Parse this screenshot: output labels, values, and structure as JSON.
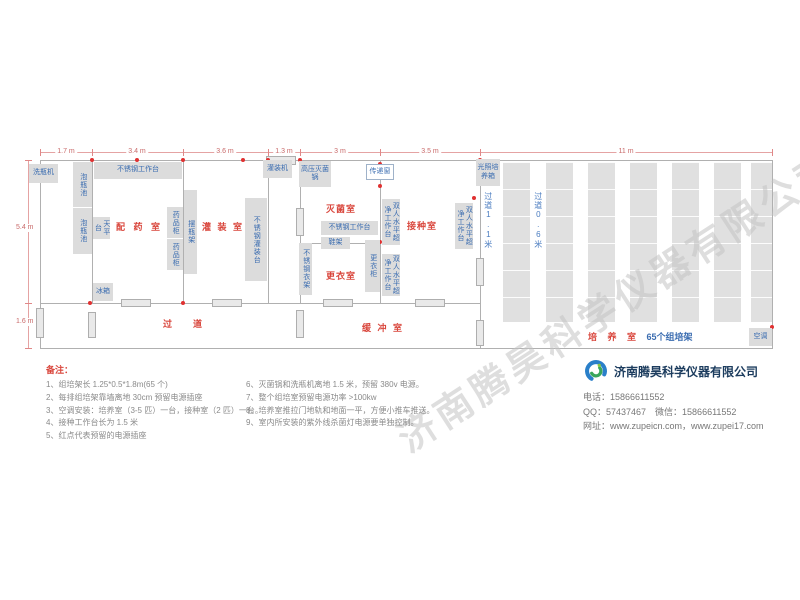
{
  "watermark": "济南腾昊科学仪器有限公司",
  "company": {
    "name": "济南腾昊科学仪器有限公司",
    "phone_line": "电话：15866611552",
    "qq_line": "QQ：57437467　微信：15866611552",
    "web_line": "网址：www.zupeicn.com，www.zupei17.com"
  },
  "notes": {
    "title": "备注：",
    "col1": [
      "1、组培架长 1.25*0.5*1.8m(65 个)",
      "2、每排组培架靠墙离地 30cm 预留电源插座",
      "3、空调安装：培养室（3-5 匹）一台，接种室（2 匹）一台。",
      "4、接种工作台长为 1.5 米",
      "5、红点代表预留的电源插座"
    ],
    "col2": [
      "6、灭菌锅和洗瓶机离地 1.5 米，预留 380v 电源。",
      "7、整个组培室预留电源功率 >100kw",
      "8、培养室推拉门地轨和地面一平，方便小推车推送。",
      "9、室内所安装的紫外线杀菌灯电源要单独控制。"
    ]
  },
  "colors": {
    "room_label_red": "#d9463c",
    "equipment_blue": "#3a6cb0",
    "dimension_pink": "#c96a6a",
    "outlet_red": "#e03131",
    "wall_gray": "#b0b0b0"
  },
  "plan": {
    "walls": [
      [
        40,
        160,
        733,
        1
      ],
      [
        40,
        348,
        733,
        1
      ],
      [
        40,
        160,
        1,
        189
      ],
      [
        772,
        160,
        1,
        189
      ],
      [
        92,
        160,
        1,
        144
      ],
      [
        183,
        160,
        1,
        144
      ],
      [
        268,
        160,
        1,
        144
      ],
      [
        300,
        160,
        1,
        144
      ],
      [
        380,
        160,
        1,
        144
      ],
      [
        480,
        160,
        1,
        189
      ],
      [
        300,
        243,
        81,
        1
      ],
      [
        40,
        303,
        441,
        1
      ]
    ],
    "doors": [
      [
        121,
        299,
        30,
        8
      ],
      [
        212,
        299,
        30,
        8
      ],
      [
        323,
        299,
        30,
        8
      ],
      [
        415,
        299,
        30,
        8
      ],
      [
        266,
        156,
        30,
        9
      ],
      [
        296,
        208,
        8,
        28
      ],
      [
        296,
        310,
        8,
        28
      ],
      [
        476,
        258,
        8,
        28
      ],
      [
        476,
        320,
        8,
        26
      ],
      [
        36,
        308,
        8,
        30
      ],
      [
        88,
        312,
        8,
        26
      ]
    ],
    "racks": [
      [
        503,
        162,
        27,
        160
      ],
      [
        546,
        162,
        27,
        160
      ],
      [
        588,
        162,
        27,
        160
      ],
      [
        630,
        162,
        27,
        160
      ],
      [
        672,
        162,
        27,
        160
      ],
      [
        714,
        162,
        27,
        160
      ],
      [
        751,
        162,
        21,
        160
      ]
    ],
    "outlets": [
      [
        92,
        160
      ],
      [
        137,
        160
      ],
      [
        183,
        160
      ],
      [
        243,
        160
      ],
      [
        268,
        160
      ],
      [
        300,
        160
      ],
      [
        480,
        160
      ],
      [
        380,
        164
      ],
      [
        380,
        186
      ],
      [
        474,
        198
      ],
      [
        380,
        242
      ],
      [
        183,
        303
      ],
      [
        90,
        303
      ],
      [
        772,
        327
      ]
    ],
    "equipment": [
      {
        "name": "bottle-washer-box",
        "label": "洗瓶机",
        "x": 29,
        "y": 164,
        "w": 29,
        "h": 19
      },
      {
        "name": "bottle-soak-pool-1",
        "label": "泡瓶池",
        "x": 73,
        "y": 162,
        "w": 19,
        "h": 45,
        "v": true
      },
      {
        "name": "bottle-soak-pool-2",
        "label": "泡瓶池",
        "x": 73,
        "y": 208,
        "w": 19,
        "h": 46,
        "v": true
      },
      {
        "name": "ss-worktable-left",
        "label": "不锈钢工作台",
        "x": 94,
        "y": 162,
        "w": 88,
        "h": 17
      },
      {
        "name": "balance-table",
        "label": "天平台",
        "x": 93,
        "y": 217,
        "w": 17,
        "h": 22,
        "v": true
      },
      {
        "name": "medicine-cabinet-1",
        "label": "药品柜",
        "x": 167,
        "y": 207,
        "w": 16,
        "h": 31,
        "v": true
      },
      {
        "name": "medicine-cabinet-2",
        "label": "药品柜",
        "x": 167,
        "y": 239,
        "w": 16,
        "h": 31,
        "v": true
      },
      {
        "name": "fridge-box",
        "label": "冰箱",
        "x": 93,
        "y": 283,
        "w": 20,
        "h": 18
      },
      {
        "name": "bottle-rack-column",
        "label": "摆瓶架",
        "x": 184,
        "y": 190,
        "w": 13,
        "h": 84,
        "v": true
      },
      {
        "name": "filling-machine-box",
        "label": "灌装机",
        "x": 263,
        "y": 160,
        "w": 29,
        "h": 18
      },
      {
        "name": "ss-filling-table",
        "label": "不锈钢灌装台",
        "x": 245,
        "y": 198,
        "w": 22,
        "h": 83,
        "v": true
      },
      {
        "name": "autoclave-box",
        "label": "高压灭菌锅",
        "x": 299,
        "y": 161,
        "w": 32,
        "h": 26
      },
      {
        "name": "pass-window-box",
        "label": "传递窗",
        "x": 366,
        "y": 164,
        "w": 28,
        "h": 16,
        "o": true
      },
      {
        "name": "ss-worktable-mid",
        "label": "不锈钢工作台",
        "x": 321,
        "y": 221,
        "w": 57,
        "h": 14
      },
      {
        "name": "shoe-rack-box",
        "label": "鞋架",
        "x": 321,
        "y": 237,
        "w": 29,
        "h": 12
      },
      {
        "name": "wardrobe-box",
        "label": "更衣柜",
        "x": 365,
        "y": 240,
        "w": 15,
        "h": 52,
        "v": true
      },
      {
        "name": "ss-clothes-rack",
        "label": "不锈钢衣架",
        "x": 299,
        "y": 243,
        "w": 13,
        "h": 52,
        "v": true
      },
      {
        "name": "clean-bench-1",
        "label": "双人水平超净工作台",
        "x": 382,
        "y": 199,
        "w": 18,
        "h": 46,
        "v": true
      },
      {
        "name": "clean-bench-2",
        "label": "双人水平超净工作台",
        "x": 455,
        "y": 203,
        "w": 18,
        "h": 46,
        "v": true
      },
      {
        "name": "clean-bench-3",
        "label": "双人水平超净工作台",
        "x": 382,
        "y": 254,
        "w": 18,
        "h": 42,
        "v": true
      },
      {
        "name": "light-incubator-box",
        "label": "光照培养箱",
        "x": 476,
        "y": 159,
        "w": 24,
        "h": 27
      },
      {
        "name": "air-conditioner-box",
        "label": "空调",
        "x": 749,
        "y": 328,
        "w": 23,
        "h": 18
      }
    ],
    "room_labels": [
      {
        "name": "room-label-dispensing",
        "label": "配 药 室",
        "x": 116,
        "y": 220,
        "ls": 3
      },
      {
        "name": "room-label-filling",
        "label": "灌 装 室",
        "x": 202,
        "y": 220,
        "ls": 2
      },
      {
        "name": "room-label-sterilization",
        "label": "灭菌室",
        "x": 326,
        "y": 202,
        "ls": 1
      },
      {
        "name": "room-label-inoculation",
        "label": "接种室",
        "x": 407,
        "y": 219,
        "ls": 1
      },
      {
        "name": "room-label-changing",
        "label": "更衣室",
        "x": 326,
        "y": 269,
        "ls": 1
      },
      {
        "name": "room-label-corridor",
        "label": "过　道",
        "x": 163,
        "y": 317,
        "ls": 6
      },
      {
        "name": "room-label-buffer",
        "label": "缓 冲 室",
        "x": 362,
        "y": 321,
        "ls": 2
      }
    ],
    "culture_label": {
      "red": "培 养 室 ",
      "blue": "65个组培架"
    },
    "corridor_labels": [
      {
        "name": "aisle-width-1",
        "label": "过道1.1米",
        "x": 483,
        "y": 192
      },
      {
        "name": "aisle-width-2",
        "label": "过道0.6米",
        "x": 533,
        "y": 192
      }
    ],
    "dim_top": {
      "y": 152,
      "x1": 40,
      "x2": 772,
      "ticks": [
        40,
        92,
        183,
        268,
        300,
        380,
        480,
        772
      ],
      "labels": [
        {
          "t": "1.7 m",
          "x": 66
        },
        {
          "t": "3.4 m",
          "x": 137
        },
        {
          "t": "3.6 m",
          "x": 225
        },
        {
          "t": "1.3 m",
          "x": 284
        },
        {
          "t": "3 m",
          "x": 340
        },
        {
          "t": "3.5 m",
          "x": 430
        },
        {
          "t": "11 m",
          "x": 626
        }
      ]
    },
    "dim_left": {
      "x": 28,
      "y1": 160,
      "y2": 348,
      "ticks": [
        160,
        303,
        348
      ],
      "labels": [
        {
          "t": "5.4 m",
          "y": 228
        },
        {
          "t": "1.6 m",
          "y": 322
        }
      ]
    }
  }
}
